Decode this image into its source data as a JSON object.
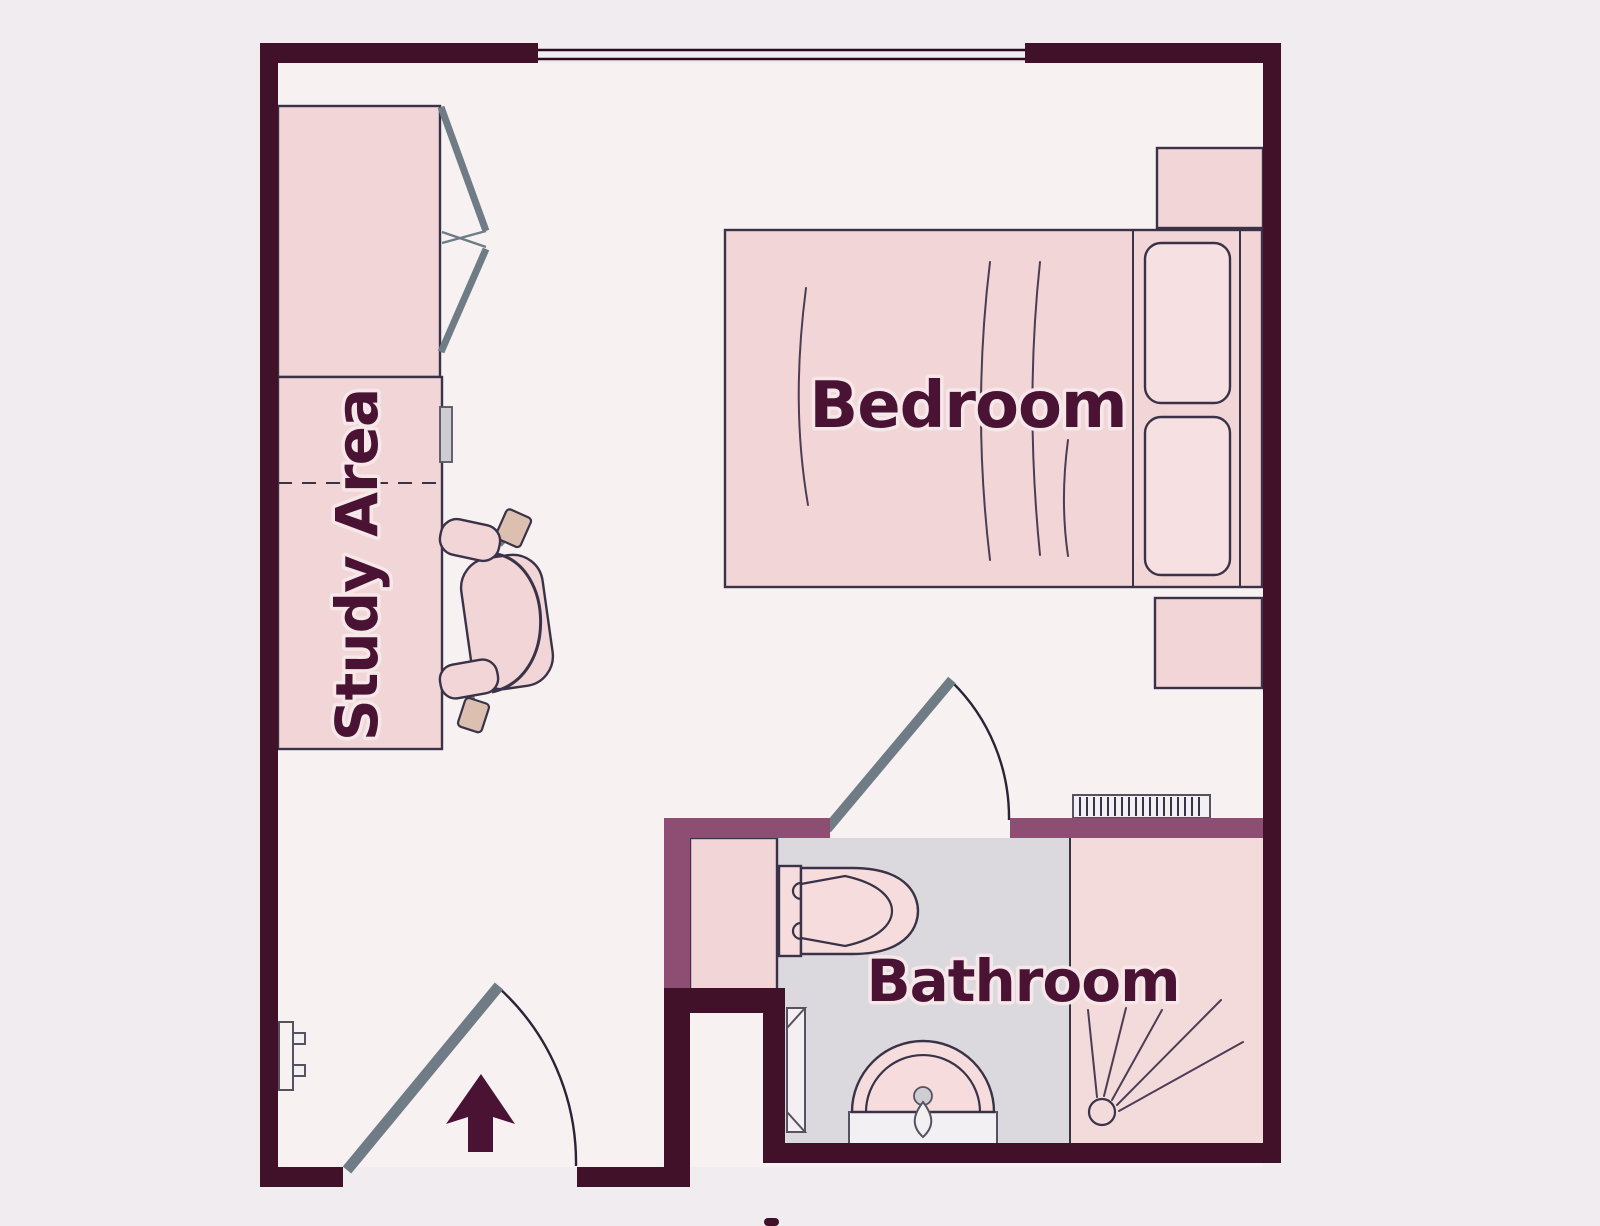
{
  "title": "Studio apartment floor plan",
  "rooms": {
    "bedroom": {
      "label": "Bedroom"
    },
    "bathroom": {
      "label": "Bathroom"
    },
    "study_area": {
      "label": "Study Area"
    }
  },
  "symbols": [
    "bed",
    "pillow",
    "nightstand",
    "wardrobe",
    "bifold-closet-door",
    "desk",
    "office-chair",
    "entry-door",
    "entry-direction-arrow",
    "bathroom-door",
    "toilet",
    "sink",
    "shower-spray",
    "radiator",
    "towel-rail",
    "window",
    "wall-panel",
    "storage-cabinet"
  ],
  "colors": {
    "page_bg": "#f1ecef",
    "floor_main": "#f7f1f2",
    "floor_bath": "#dcd9de",
    "floor_shower": "#f3dadb",
    "wall_dark": "#401129",
    "wall_plum": "#8e4d72",
    "furniture_pink": "#f2d5d7",
    "furniture_pink_light": "#f6e0e1",
    "fixture_pink": "#f6dcdc",
    "outline": "#3a3347",
    "outline_soft": "#57525f",
    "door_gray": "#6f7c86",
    "arc_line": "#2e2234",
    "window_line": "#2e0a1e",
    "fold_line": "#4d3c55",
    "label_color": "#4a1233",
    "label_halo": "#f6e7e9",
    "metal_gray": "#cfcdd4",
    "white_fixture": "#f3f0f3",
    "caster_tan": "#dcbfb0"
  }
}
